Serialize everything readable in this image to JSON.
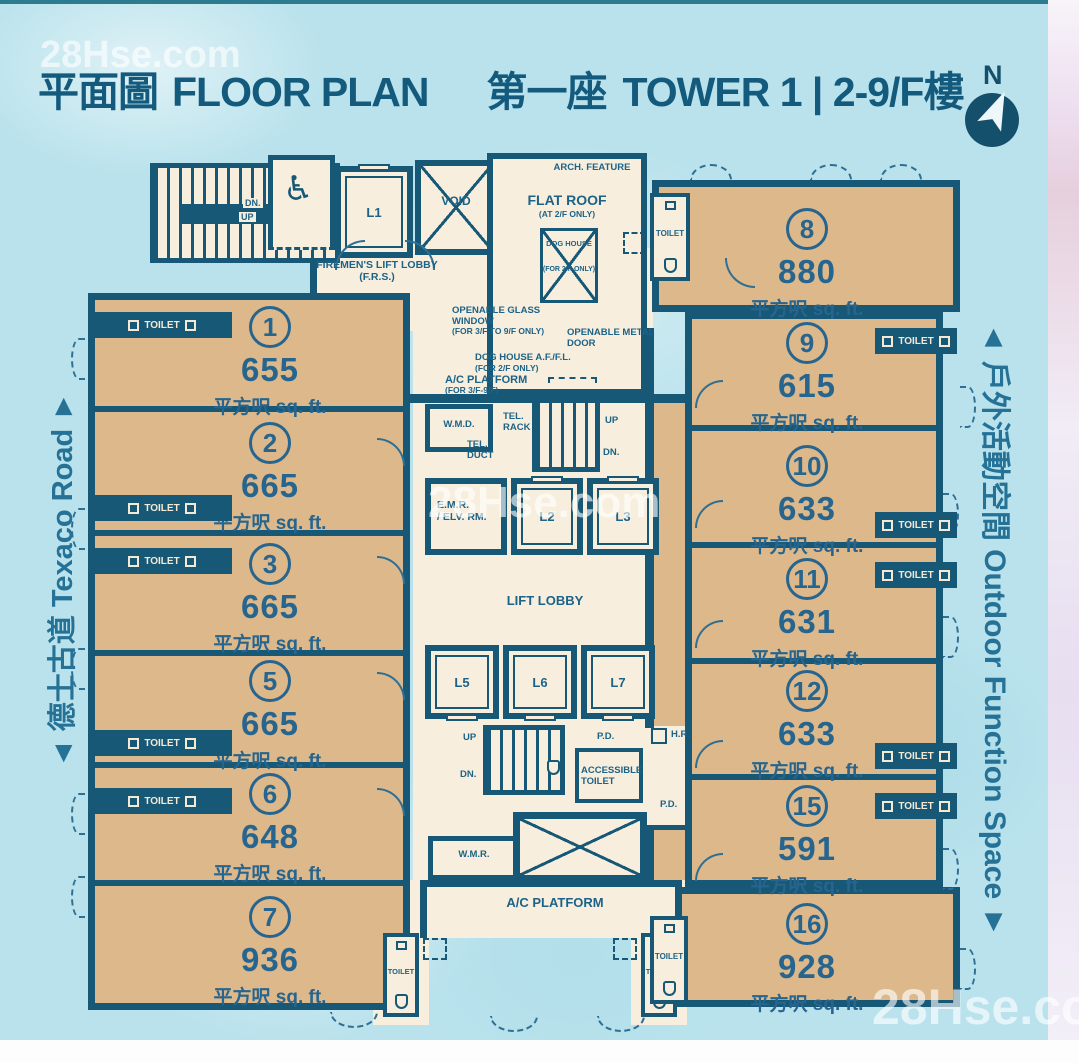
{
  "header": {
    "title_zh": "平面圖",
    "title_en": "FLOOR PLAN",
    "tower_zh": "第一座",
    "tower_en": "TOWER 1 | 2-9/F樓"
  },
  "compass": {
    "n": "N"
  },
  "roads": {
    "left": "◄ 德士古道 Texaco Road ►",
    "right": "◄ 戶外活動空間 Outdoor Function Space ►"
  },
  "watermarks": {
    "top_left": "28Hse.com",
    "center": "28Hse.com",
    "bottom_right": "28Hse.com"
  },
  "area_unit": "平方呎 sq. ft.",
  "labels": {
    "toilet": "TOILET"
  },
  "units": {
    "left": [
      {
        "number": "1",
        "area": "655"
      },
      {
        "number": "2",
        "area": "665"
      },
      {
        "number": "3",
        "area": "665"
      },
      {
        "number": "5",
        "area": "665"
      },
      {
        "number": "6",
        "area": "648"
      },
      {
        "number": "7",
        "area": "936"
      }
    ],
    "right": [
      {
        "number": "8",
        "area": "880"
      },
      {
        "number": "9",
        "area": "615"
      },
      {
        "number": "10",
        "area": "633"
      },
      {
        "number": "11",
        "area": "631"
      },
      {
        "number": "12",
        "area": "633"
      },
      {
        "number": "15",
        "area": "591"
      },
      {
        "number": "16",
        "area": "928"
      }
    ]
  },
  "core": {
    "l1": "L1",
    "void": "VOID",
    "firemens": "FIREMEN'S LIFT LOBBY (F.R.S.)",
    "arch": "ARCH. FEATURE",
    "flat_roof": "FLAT ROOF",
    "flat_roof_note": "(AT 2/F ONLY)",
    "dog_house": "DOG HOUSE",
    "dog_house_note": "(FOR 2/F ONLY)",
    "glass1": "OPENABLE GLASS WINDOW",
    "glass2": "(FOR 3/F TO 9/F ONLY)",
    "metal": "OPENABLE METAL DOOR",
    "dh_affl": "DOG HOUSE A.F./F.L.",
    "dh_affl_note": "(FOR 2/F ONLY)",
    "acp_mid": "A/C PLATFORM",
    "acp_mid_note": "(FOR 3/F-9/F)",
    "wmd": "W.M.D.",
    "tel_rack": "TEL. RACK",
    "tel_duct": "TEL. DUCT",
    "up": "UP",
    "dn": "DN.",
    "emr1": "E.M.R.",
    "emr2": "/ ELV. RM.",
    "l2": "L2",
    "l3": "L3",
    "lift_lobby": "LIFT LOBBY",
    "l5": "L5",
    "l6": "L6",
    "l7": "L7",
    "pd": "P.D.",
    "hr": "H.R.",
    "acc1": "ACCESSIBLE",
    "acc2": "TOILET",
    "wmr": "W.M.R.",
    "acp_bottom": "A/C PLATFORM"
  }
}
